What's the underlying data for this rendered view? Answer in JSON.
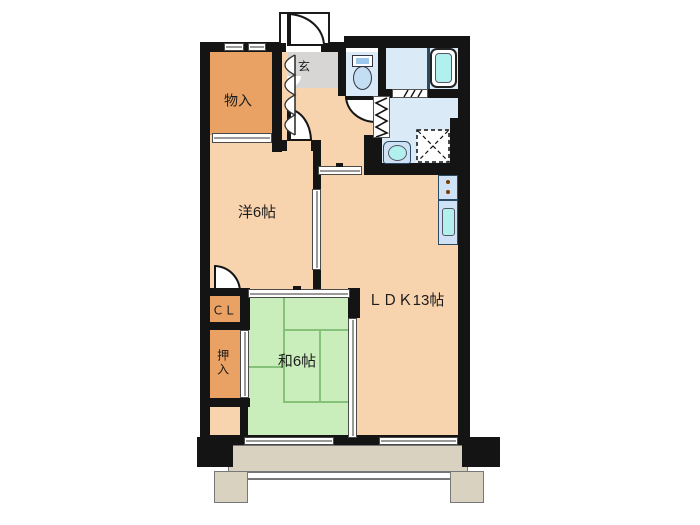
{
  "rooms": {
    "monoire": {
      "label": "物入"
    },
    "genkan": {
      "label": "玄"
    },
    "western": {
      "label": "洋6帖"
    },
    "ldk": {
      "label": "ＬＤＫ13帖"
    },
    "washitsu": {
      "label": "和6帖"
    },
    "cl": {
      "label": "ＣＬ"
    },
    "oshiire": {
      "label": "押入"
    }
  },
  "colors": {
    "wall": "#141414",
    "floor": "#f8d4ae",
    "closet": "#e9a263",
    "genkan": "#d7d6d4",
    "wet": "#daeaf7",
    "counter": "#cfe2f5",
    "fixture": "#b2f0ee",
    "tatami": "#c9eebb",
    "tatamiLine": "#85c178",
    "balcony": "#d9d2c1",
    "text": "#1c1c1c"
  }
}
